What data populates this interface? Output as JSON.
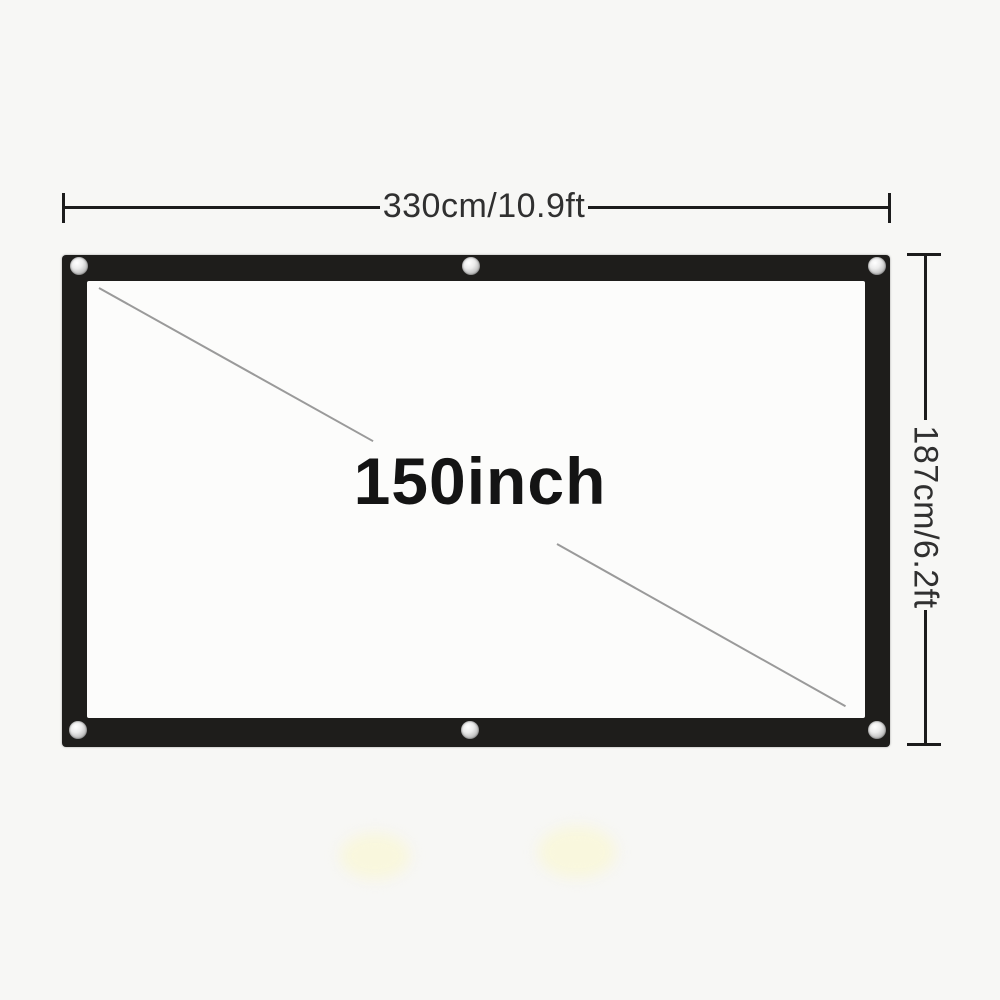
{
  "page": {
    "description": "Projection screen size diagram",
    "background_color": "#f7f7f5"
  },
  "diagram": {
    "width_label": "330cm/10.9ft",
    "height_label": "187cm/6.2ft",
    "diagonal_label": "150inch",
    "grommet_count": 6,
    "colors": {
      "frame": "#1e1d1b",
      "screen_surface": "#fcfcfb",
      "dimension_line": "#1c1c1c",
      "diagonal_line": "#9a9a9a",
      "dimension_text": "#303030",
      "diagonal_text": "#141414",
      "grommet": "#bdbdbd"
    }
  }
}
